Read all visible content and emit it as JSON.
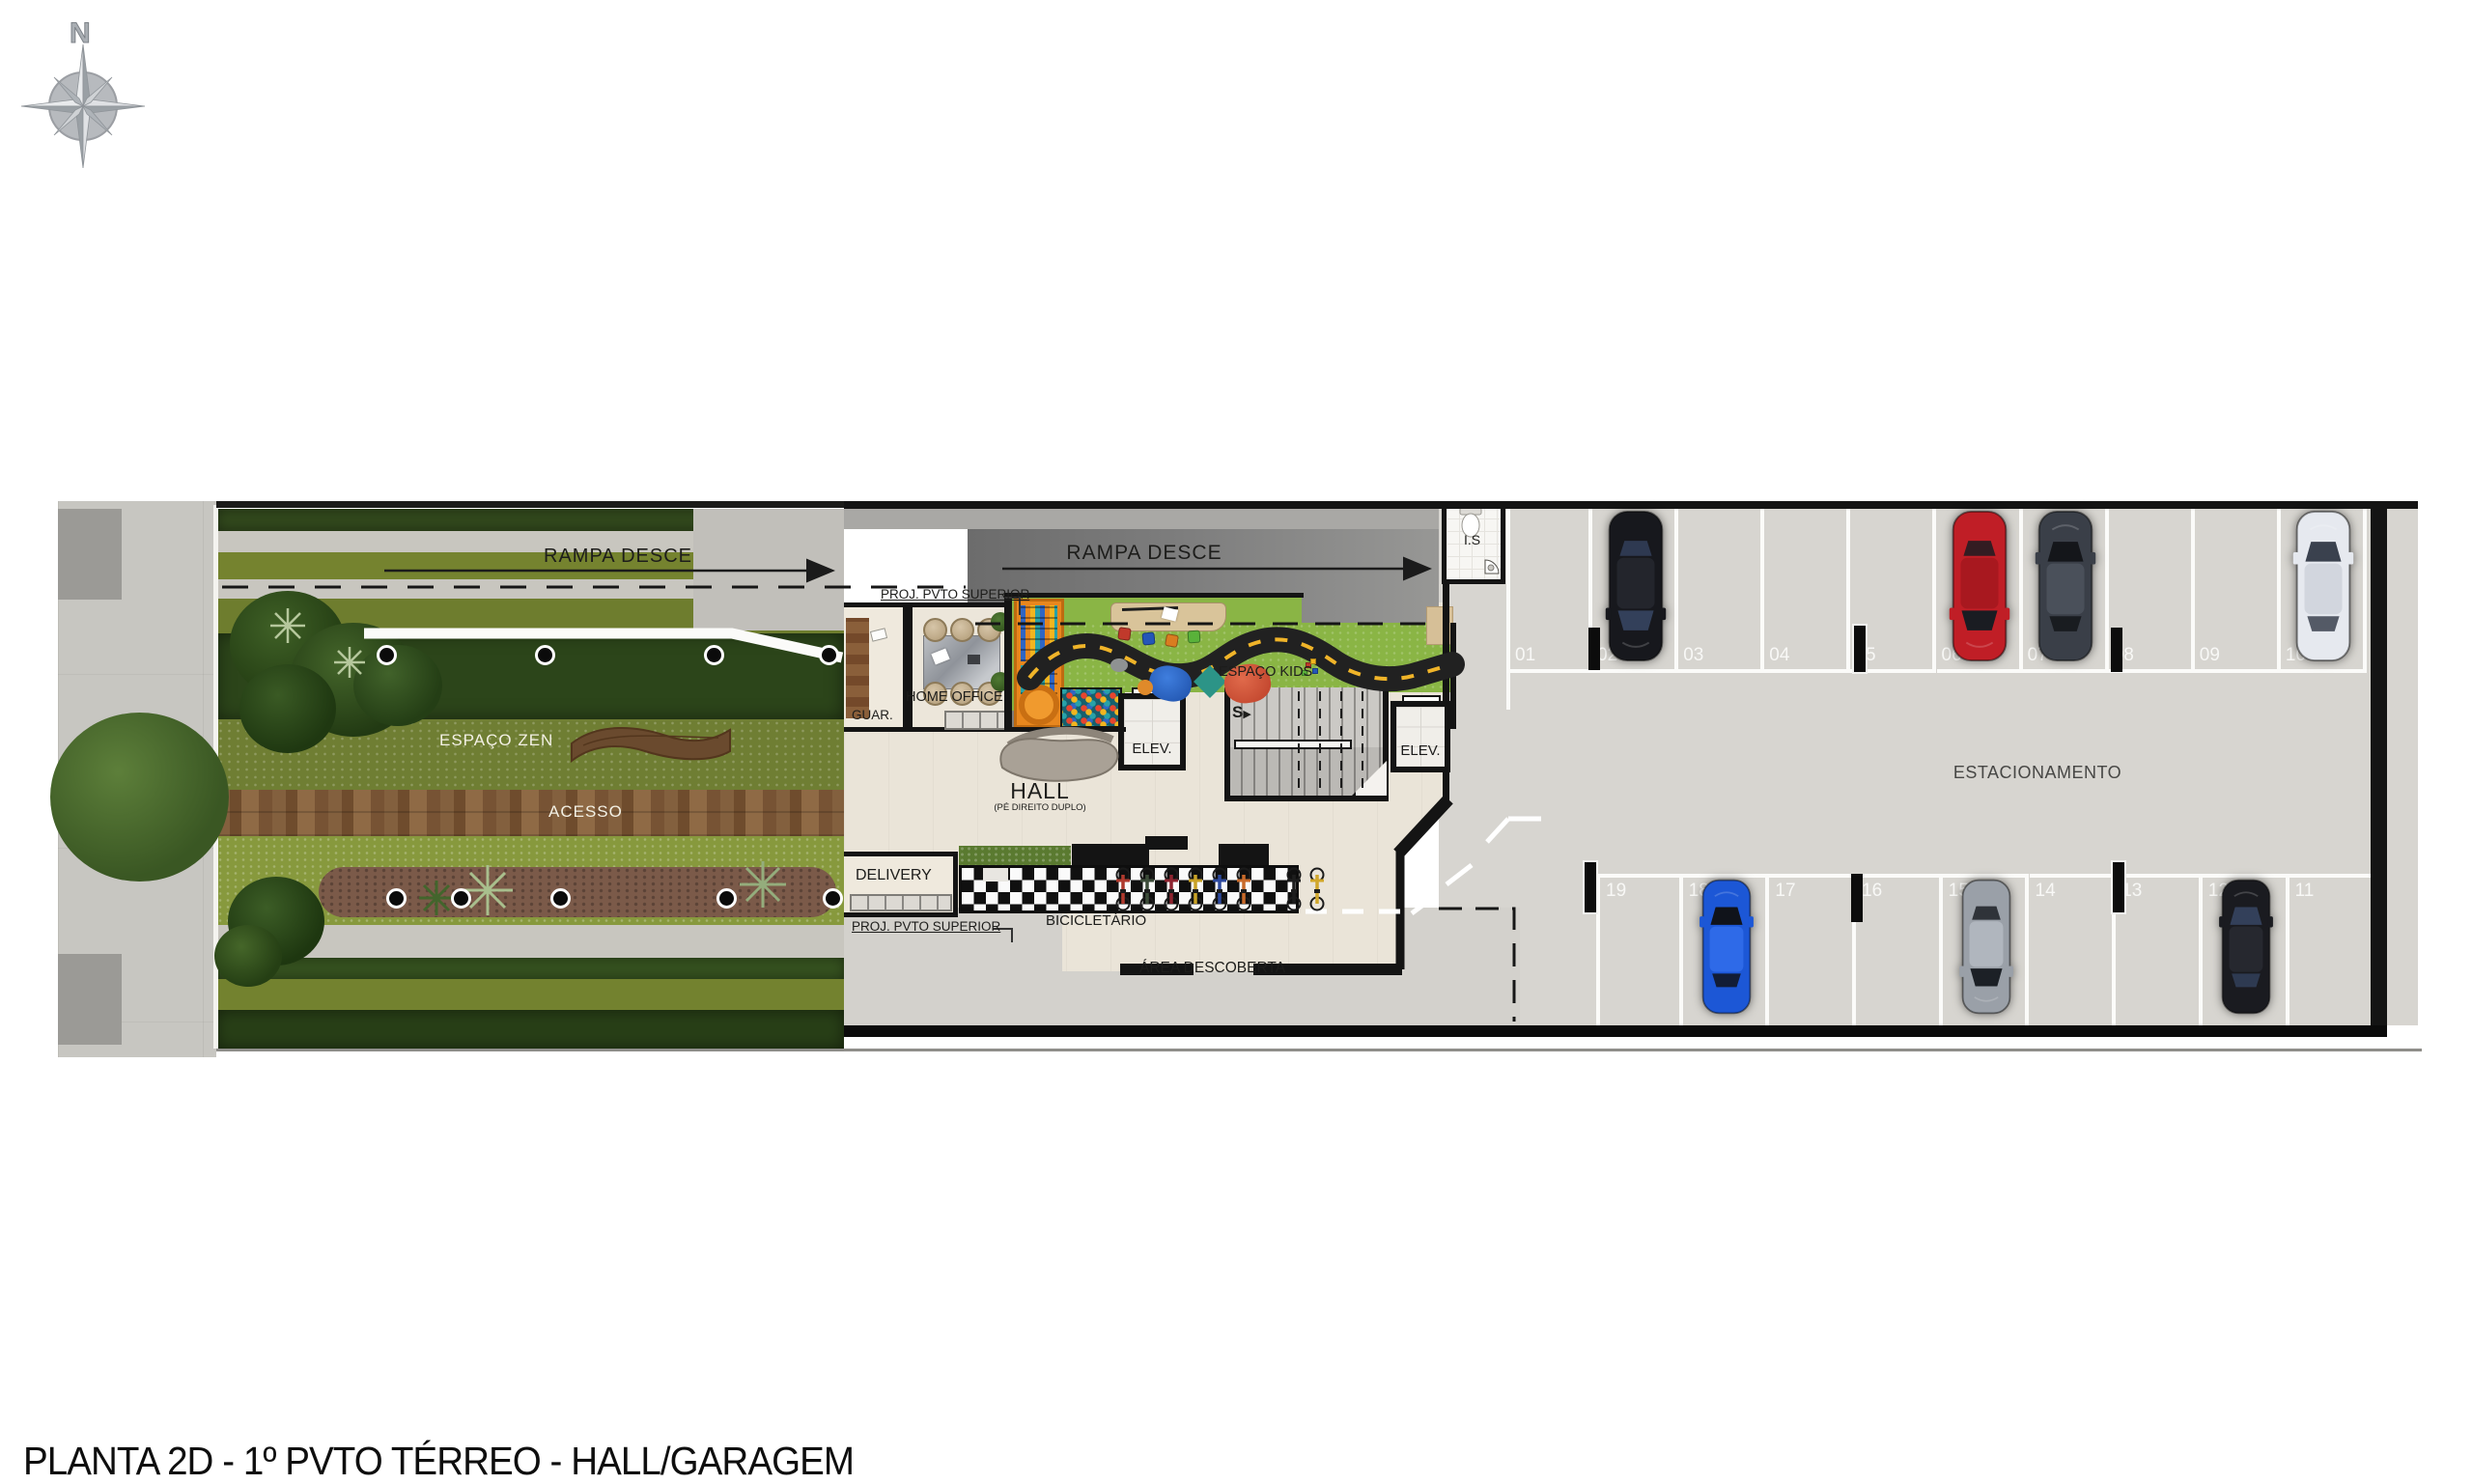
{
  "plan_title": "PLANTA 2D - 1º PVTO TÉRREO - HALL/GARAGEM",
  "compass": {
    "north": "N"
  },
  "garden": {
    "ramp": "RAMPA DESCE",
    "zen": "ESPAÇO ZEN",
    "access": "ACESSO"
  },
  "hall_block": {
    "ramp": "RAMPA DESCE",
    "proj_top": "PROJ. PVTO SUPERIOR",
    "proj_bottom": "PROJ. PVTO SUPERIOR",
    "bathroom": "I.S",
    "guard": "GUAR.",
    "home_office": "HOME OFFICE",
    "kids": "ESPAÇO KIDS",
    "elevator1": "ELEV.",
    "elevator2": "ELEV.",
    "stairs_dir": "S",
    "hall": "HALL",
    "hall_note": "(PÉ DIREITO DUPLO)",
    "delivery": "DELIVERY",
    "bike_rack": "BICICLETÁRIO",
    "open_area": "ÁREA DESCOBERTA",
    "bike_colors": [
      "#b03a2e",
      "#3d4d3a",
      "#8e2430",
      "#c9a227",
      "#2e4a9e",
      "#c96a2a",
      "#1d1d1d",
      "#d1a72b"
    ]
  },
  "parking": {
    "label": "ESTACIONAMENTO",
    "top_row": [
      {
        "number": "01",
        "car": null
      },
      {
        "number": "02",
        "car": {
          "body": "#17181d",
          "roof": "#23252c",
          "glass": "#33405a",
          "dir": "down"
        }
      },
      {
        "number": "03",
        "car": null
      },
      {
        "number": "04",
        "car": null
      },
      {
        "number": "05",
        "car": null
      },
      {
        "number": "06",
        "car": {
          "body": "#c01e26",
          "roof": "#a8181f",
          "glass": "#1a1c22",
          "dir": "down"
        }
      },
      {
        "number": "07",
        "car": {
          "body": "#3a3f48",
          "roof": "#4a505a",
          "glass": "#14161a",
          "dir": "up"
        }
      },
      {
        "number": "08",
        "car": null
      },
      {
        "number": "09",
        "car": null
      },
      {
        "number": "10",
        "car": {
          "body": "#e6e9ef",
          "roof": "#d2d6de",
          "glass": "#3a414e",
          "dir": "up"
        }
      }
    ],
    "bottom_row": [
      {
        "number": "19",
        "car": null
      },
      {
        "number": "18",
        "car": {
          "body": "#1c57d6",
          "roof": "#2e6ae8",
          "glass": "#10131a",
          "dir": "up"
        }
      },
      {
        "number": "17",
        "car": null
      },
      {
        "number": "16",
        "car": null
      },
      {
        "number": "15",
        "car": {
          "body": "#9aa0a8",
          "roof": "#b0b6be",
          "glass": "#1c2026",
          "dir": "down"
        }
      },
      {
        "number": "14",
        "car": null
      },
      {
        "number": "13",
        "car": null
      },
      {
        "number": "12",
        "car": {
          "body": "#1a1b20",
          "roof": "#26282f",
          "glass": "#33405a",
          "dir": "up"
        }
      },
      {
        "number": "11",
        "car": null
      }
    ]
  },
  "palette": {
    "grass_olive": "#75832f",
    "hedge_dark": "#2c451a",
    "deck": "#7a5637",
    "hall_floor": "#eae4d8",
    "concrete": "#d6d4cf",
    "wall": "#141414",
    "kids_grass": "#8ab545",
    "track": "#212121",
    "track_dash": "#f0b429",
    "ramp": "#7c7c7c"
  }
}
